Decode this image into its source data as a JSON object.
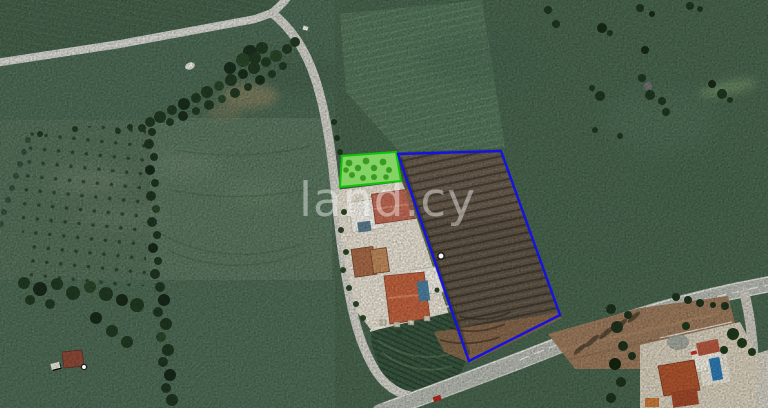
{
  "map": {
    "kind": "satellite-aerial-view",
    "watermark": {
      "text": "land.cy",
      "color": "#ffffff",
      "opacity": "0.42",
      "font_size": "47"
    },
    "overlays": {
      "green_plot": {
        "points": "342,156 396,152 401,181 340,187",
        "fill": "#3fd41d",
        "fill_opacity": "0.55",
        "stroke": "#10c405",
        "stroke_width": "2"
      },
      "blue_plot": {
        "points": "398,154 501,151 560,315 469,361",
        "fill": "none",
        "stroke": "#1414e0",
        "stroke_width": "2.4"
      },
      "plot_marker": {
        "cx": "441",
        "cy": "256",
        "r": "3.2",
        "fill": "#f8f7f2",
        "stroke": "#1d1d1d"
      },
      "field_marker": {
        "cx": "84",
        "cy": "367",
        "r": "2.6",
        "fill": "#f8f7f2",
        "stroke": "#1d1d1d"
      }
    }
  }
}
